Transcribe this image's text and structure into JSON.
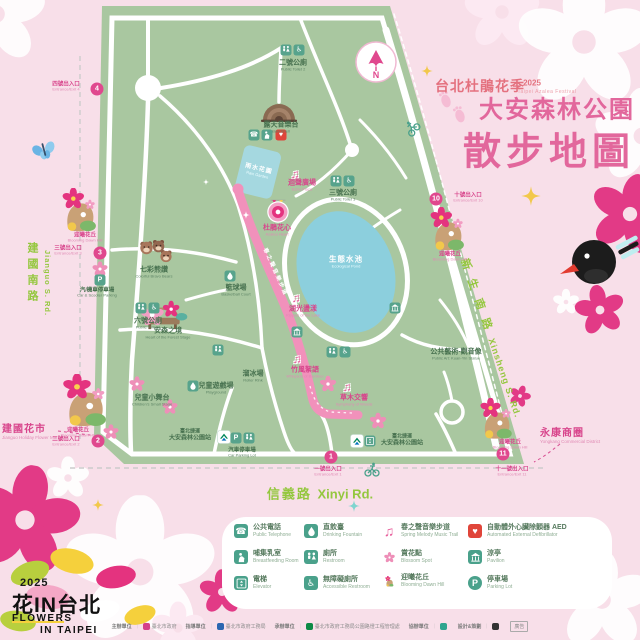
{
  "header": {
    "festival_zh": "台北杜鵑花季",
    "festival_year": "2025",
    "festival_en": "Taipei Azalea Festival",
    "park_name": "大安森林公園",
    "map_title": "散步地圖"
  },
  "compass": {
    "north": "N"
  },
  "roads": {
    "left_zh": "建國南路",
    "left_en": "Jianguo S. Rd.",
    "right_zh": "新生南路",
    "right_en": "Xinsheng S. Rd.",
    "bottom_zh": "信義路",
    "bottom_en": "Xinyi Rd."
  },
  "nearby": {
    "flower_market_zh": "建國花市",
    "flower_market_en": "Jianguo Holiday Flower Market",
    "yongkang_zh": "永康商圈",
    "yongkang_en": "Yongkang Commercial District"
  },
  "entrances": {
    "e1": {
      "num": "1",
      "zh": "一號出入口",
      "en": "Entrance/Exit 1"
    },
    "e2": {
      "num": "2",
      "zh": "二號出入口",
      "en": "Entrance/Exit 2"
    },
    "e3": {
      "num": "3",
      "zh": "三號出入口",
      "en": "Entrance/Exit 3"
    },
    "e4": {
      "num": "4",
      "zh": "四號出入口",
      "en": "Entrance/Exit 4"
    },
    "e10": {
      "num": "10",
      "zh": "十號出入口",
      "en": "Entrance/Exit 10"
    },
    "e11": {
      "num": "11",
      "zh": "十一號出入口",
      "en": "Entrance/Exit 11"
    }
  },
  "features": {
    "toilet2": {
      "zh": "二號公廁",
      "en": "Public Toilet 2"
    },
    "toilet3": {
      "zh": "三號公廁",
      "en": "Public Toilet 3"
    },
    "toilet4": {
      "zh": "四號公廁",
      "en": "Public Toilet 4"
    },
    "toilet6": {
      "zh": "六號公廁",
      "en": "Public Toilet 6"
    },
    "bandshell": {
      "zh": "露天音樂台",
      "en": "Bandshell"
    },
    "rain_garden": {
      "zh": "雨水花園",
      "en": "Rain Garden"
    },
    "azalea_heart": {
      "zh": "杜鵑花心",
      "en": "Azalea Heart"
    },
    "pond": {
      "zh": "生態水池",
      "en": "Ecological Pond"
    },
    "bear_garden": {
      "zh": "七彩熊讚",
      "en": "Colorful Bravo Bears"
    },
    "forest_stage": {
      "zh": "安森之境",
      "en": "Heart of the Forest Stage"
    },
    "basketball": {
      "zh": "籃球場",
      "en": "Basketball Court"
    },
    "roller_rink": {
      "zh": "溜冰場",
      "en": "Roller Rink"
    },
    "small_stage": {
      "zh": "兒童小舞台",
      "en": "Children's Small Stage"
    },
    "playground": {
      "zh": "兒童遊戲場",
      "en": "Playground"
    },
    "guanyin": {
      "zh": "公共藝術-觀音像",
      "en": "Public Art: Kuan-Yin Statue"
    },
    "dawn_hill": {
      "zh": "迎曦花丘",
      "en": "Blooming Dawn Hill"
    },
    "mrt": {
      "line1": "臺北捷運",
      "line2": "大安森林公園站"
    },
    "car_parking": {
      "zh": "汽車停車場",
      "en": "Car Parking Lot"
    },
    "scooter_parking": {
      "zh": "汽/機車停車場",
      "en": "Car & Scooter Parking"
    }
  },
  "music_trail": {
    "path_label": "春之聲音樂步道",
    "stations": [
      {
        "zh": "迴聲廣場",
        "en": "Echo Plaza"
      },
      {
        "zh": "湖光盪漾",
        "en": "Ripples of the Lake"
      },
      {
        "zh": "竹風絮語",
        "en": "Whispers of Bamboo"
      },
      {
        "zh": "草木交響",
        "en": "Symphony of Woods"
      }
    ]
  },
  "legend": {
    "items": [
      {
        "zh": "公共電話",
        "en": "Public Telephone"
      },
      {
        "zh": "哺集乳室",
        "en": "Breastfeeding Room"
      },
      {
        "zh": "電梯",
        "en": "Elevator"
      },
      {
        "zh": "直飲臺",
        "en": "Drinking Fountain"
      },
      {
        "zh": "廁所",
        "en": "Restroom"
      },
      {
        "zh": "無障礙廁所",
        "en": "Accessible Restroom"
      },
      {
        "zh": "春之聲音樂步道",
        "en": "Spring Melody Music Trail"
      },
      {
        "zh": "賞花點",
        "en": "Blossom Spot"
      },
      {
        "zh": "迎曦花丘",
        "en": "Blooming Dawn Hill"
      },
      {
        "zh": "自動體外心臟除顫器 AED",
        "en": "Automated External Defibrillator"
      },
      {
        "zh": "涼亭",
        "en": "Pavilion"
      },
      {
        "zh": "停車場",
        "en": "Parking Lot"
      }
    ]
  },
  "logo": {
    "year": "2025",
    "zh": "花IN台北",
    "en_line1": "FLOWERS",
    "en_line2": "IN TAIPEI"
  },
  "footer": {
    "credits": [
      {
        "role": "主辦單位",
        "org": "臺北市政府"
      },
      {
        "role": "指導單位",
        "org": "臺北市政府工務局"
      },
      {
        "role": "承辦單位",
        "org": "臺北市政府工務局公園路燈工程管理處"
      },
      {
        "role": "協辦單位",
        "org": ""
      },
      {
        "role": "設計&策劃",
        "org": ""
      }
    ],
    "ad": "廣告"
  }
}
